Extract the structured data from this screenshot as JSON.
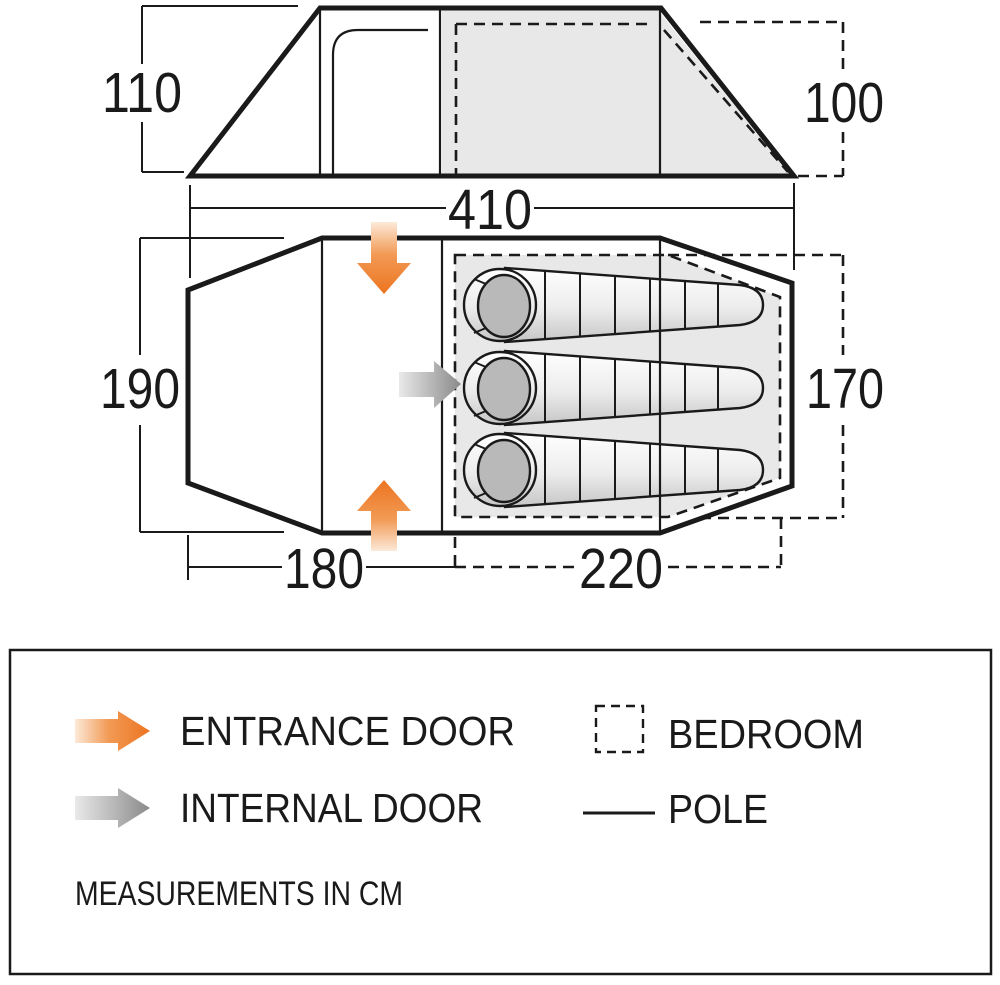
{
  "side_view": {
    "label_height_left": "110",
    "label_height_right": "100",
    "label_width": "410"
  },
  "floor_plan": {
    "label_depth_left": "190",
    "label_depth_right": "170",
    "label_living_width": "180",
    "label_bedroom_width": "220"
  },
  "legend": {
    "entrance_door_label": "ENTRANCE DOOR",
    "internal_door_label": "INTERNAL DOOR",
    "bedroom_label": "BEDROOM",
    "pole_label": "POLE",
    "note": "MEASUREMENTS IN CM"
  },
  "colors": {
    "entrance_accent": "#EC7420",
    "internal_gray": "#8A8A8A",
    "bedroom_fill": "#E8E8E8",
    "line": "#1A1A1A"
  }
}
